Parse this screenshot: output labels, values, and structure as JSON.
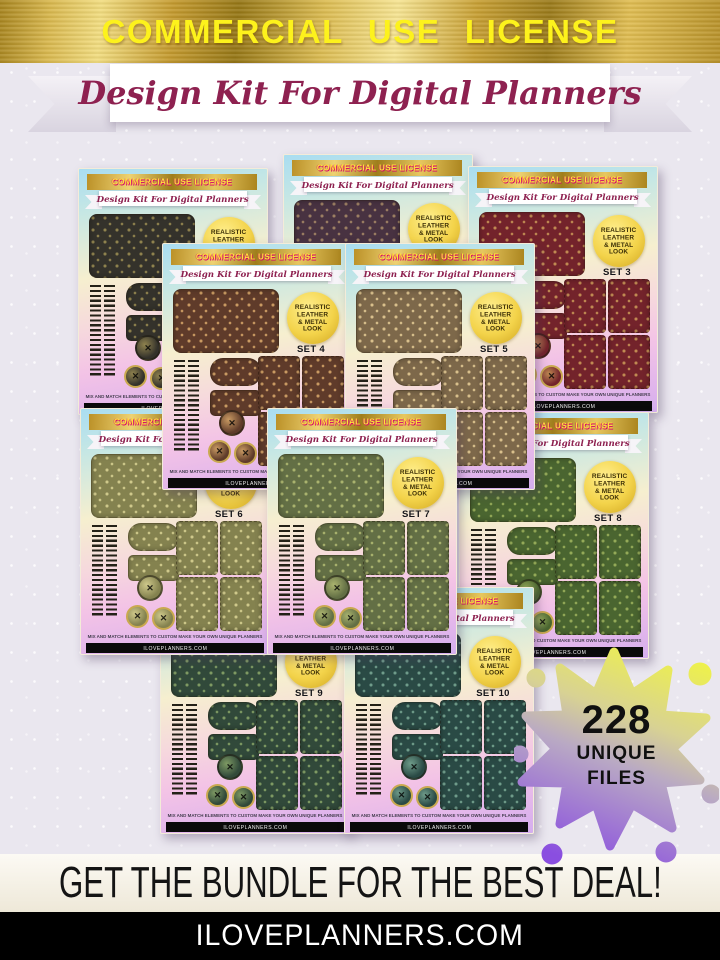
{
  "header": {
    "license_text": "COMMERCIAL USE LICENSE",
    "title_script": "Design Kit For Digital Planners"
  },
  "card_common": {
    "license_text": "COMMERCIAL USE LICENSE",
    "title_script": "Design Kit For Digital Planners",
    "badge_line1": "REALISTIC",
    "badge_line2": "LEATHER",
    "badge_line3": "& METAL",
    "badge_line4": "LOOK",
    "fine_print": "MIX AND MATCH ELEMENTS TO CUSTOM MAKE YOUR OWN UNIQUE PLANNERS",
    "website": "ILOVEPLANNERS.COM"
  },
  "cards": [
    {
      "set_label": "SET 1",
      "leather": "#34322b",
      "pattern": "#8f824e",
      "x": 78,
      "y": 168,
      "z": 1
    },
    {
      "set_label": "SET 2",
      "leather": "#483241",
      "pattern": "#9c7f63",
      "x": 283,
      "y": 154,
      "z": 2
    },
    {
      "set_label": "SET 3",
      "leather": "#73232b",
      "pattern": "#c08a52",
      "x": 468,
      "y": 166,
      "z": 3
    },
    {
      "set_label": "SET 4",
      "leather": "#5f3b2a",
      "pattern": "#c99a62",
      "x": 162,
      "y": 243,
      "z": 8
    },
    {
      "set_label": "SET 5",
      "leather": "#7d684a",
      "pattern": "#d9c08c",
      "x": 345,
      "y": 243,
      "z": 9
    },
    {
      "set_label": "SET 6",
      "leather": "#84824f",
      "pattern": "#cfc98b",
      "x": 80,
      "y": 408,
      "z": 7
    },
    {
      "set_label": "SET 7",
      "leather": "#636f45",
      "pattern": "#aab36e",
      "x": 267,
      "y": 408,
      "z": 10
    },
    {
      "set_label": "SET 8",
      "leather": "#4a6530",
      "pattern": "#94aa58",
      "x": 459,
      "y": 412,
      "z": 4
    },
    {
      "set_label": "SET 9",
      "leather": "#31493a",
      "pattern": "#7e9a63",
      "x": 160,
      "y": 587,
      "z": 5
    },
    {
      "set_label": "SET 10",
      "leather": "#2a4a45",
      "pattern": "#6f9c8a",
      "x": 344,
      "y": 587,
      "z": 6
    }
  ],
  "splat_badge": {
    "count": "228",
    "line1": "UNIQUE",
    "line2": "FILES",
    "gradient": [
      "#f0f445",
      "#d8d293",
      "#b9a9c4",
      "#8a4ee0"
    ]
  },
  "footer": {
    "tagline": "GET THE BUNDLE FOR THE BEST DEAL!",
    "website": "ILOVEPLANNERS.COM"
  },
  "colors": {
    "banner_text": "#fdf21c",
    "card_banner_text": "#ffe23a",
    "card_banner_shadow": "#d4006e",
    "script_text": "#8e2150"
  }
}
